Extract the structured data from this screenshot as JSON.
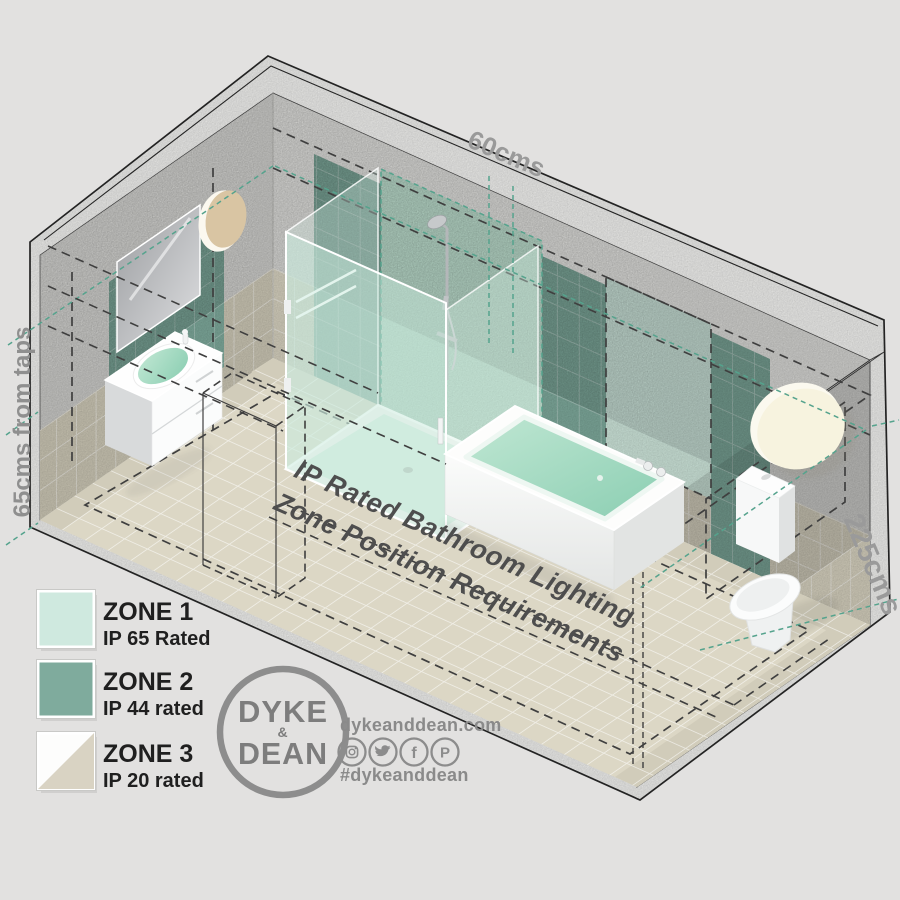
{
  "background_color": "#e2e1e0",
  "floor_title": {
    "line1": "IP Rated Bathroom Lighting",
    "line2": "Zone Position Requirements"
  },
  "dimensions": {
    "top_width": "60cms",
    "left_height": "65cms from taps",
    "right_height": "225cms"
  },
  "colors": {
    "zone1": "#cfe9df",
    "zone1_glass": "#c6e9d8",
    "zone2": "#7fab9d",
    "zone3_tile": "#d9d3c3",
    "accent_teal": "#55a38d",
    "dash_dark": "#3f3f3f",
    "label_gray": "#969696",
    "title_gray": "#4e4e4e",
    "logo_gray": "#8a8a8a"
  },
  "legend": {
    "items": [
      {
        "label": "ZONE 1",
        "rating": "IP 65 Rated",
        "color": "#cfe9df"
      },
      {
        "label": "ZONE 2",
        "rating": "IP 44 rated",
        "color": "#7fab9d"
      },
      {
        "label": "ZONE 3",
        "rating": "IP 20 rated",
        "color_top": "#fdfdfc",
        "color_bottom": "#d9d3c3"
      }
    ]
  },
  "brand": {
    "logo_top": "DYKE",
    "logo_amp": "&",
    "logo_bottom": "DEAN",
    "website": "dykeanddean.com",
    "hashtag": "#dykeanddean",
    "facebook_letter": "f",
    "pinterest_letter": "P",
    "social_icons": [
      "instagram-icon",
      "twitter-icon",
      "facebook-icon",
      "pinterest-icon"
    ]
  },
  "scene": {
    "fixtures": [
      "mirror",
      "wall-light",
      "basin-vanity",
      "shower-enclosure",
      "bathtub",
      "toilet",
      "wall-light",
      "door-outline"
    ]
  }
}
